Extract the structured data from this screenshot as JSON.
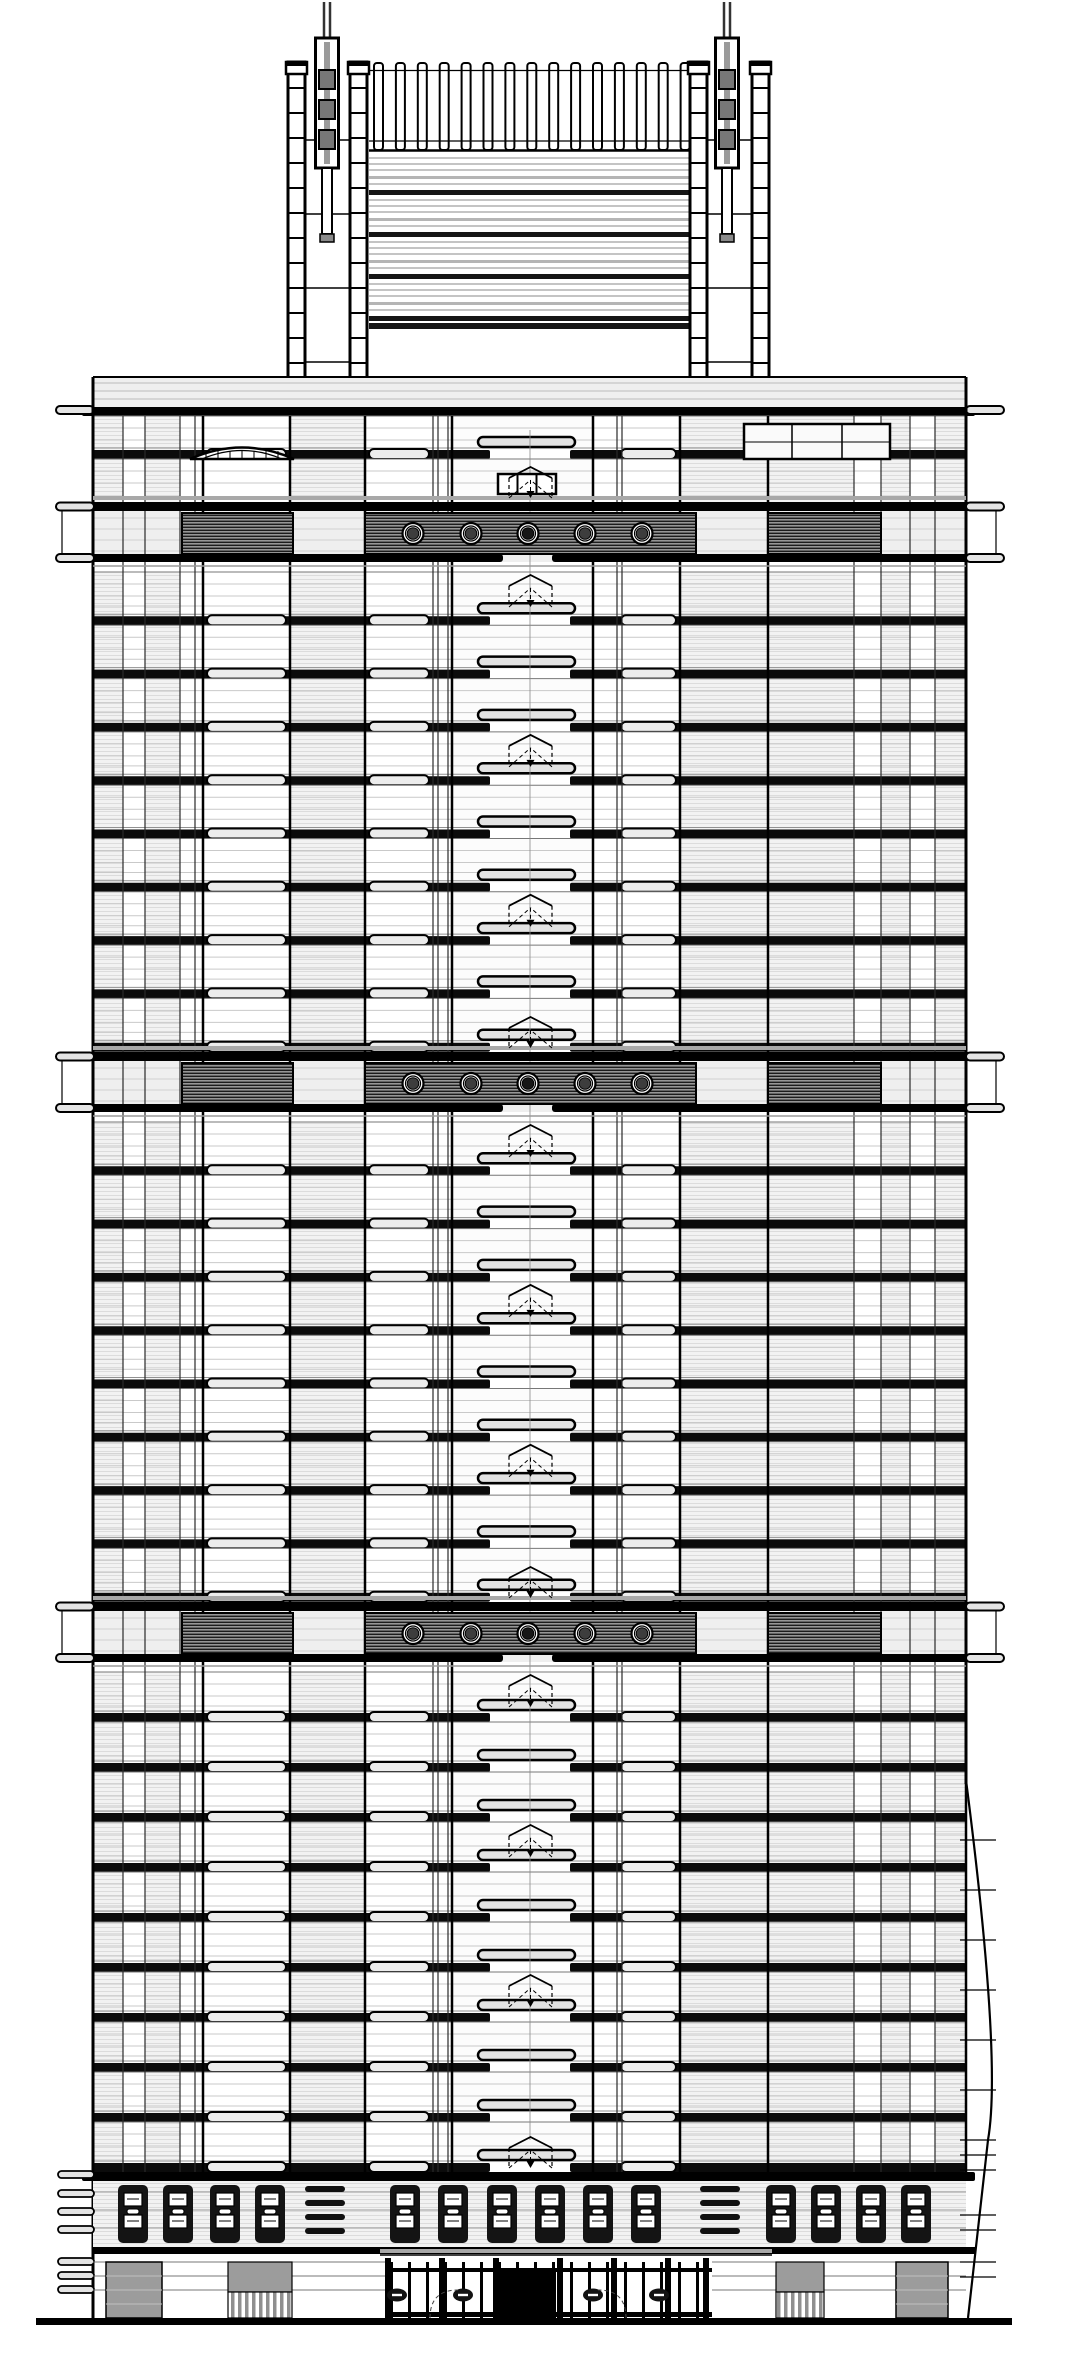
{
  "title": "High-rise office tower front elevation, black-and-white CAD architectural drawing with twin rooftop antenna masts, louvered crown, three porthole mechanical bands and street-level storefront",
  "canvas": {
    "w": 1080,
    "h": 2354,
    "bg": "#ffffff"
  },
  "colors": {
    "ink": "#000000",
    "spandrel": "#0b0b0b",
    "mid": "#777777",
    "soft": "#a8a8a8",
    "faint": "#c9c9c9",
    "panelbg": "#efefef",
    "capfill": "#e4e4e4",
    "graypanel": "#9c9c9c",
    "pillfill": "#e2e2e2",
    "widepill": "#ececec",
    "mastseg": "#777777",
    "darkpanel": "#141414"
  },
  "crown": {
    "masts": {
      "cx": [
        327,
        727
      ],
      "rod_top": 2,
      "sleeve": {
        "y": 38,
        "h": 130,
        "w": 23
      },
      "segments_y": [
        70,
        100,
        130
      ],
      "segment_h": 19,
      "lower_rod": {
        "y": 168,
        "h": 66,
        "w": 10
      },
      "foot": {
        "y": 234,
        "h": 8,
        "w": 14
      }
    },
    "towers": {
      "rail_w": 17,
      "rail_pairs": [
        [
          288,
          350
        ],
        [
          690,
          752
        ]
      ],
      "y": 62,
      "h": 318,
      "rung_pitch": 25,
      "cross_pitch": 74,
      "cap_h": 12
    },
    "fins": {
      "x0": 374,
      "count": 15,
      "w": 9,
      "pitch": 21.9,
      "y": 63,
      "h": 87,
      "tie_y": [
        70.5,
        141
      ],
      "base_y": 150.5,
      "span": [
        369,
        696
      ]
    },
    "stripes": {
      "x": 369,
      "w": 327,
      "y": 152,
      "h": 178,
      "unit": 42,
      "units": 4,
      "start": 158
    }
  },
  "shoulder": {
    "slab_y": 377,
    "slab_h": 30,
    "bar_y": 407,
    "bar_h": 9,
    "lines": [
      383,
      391,
      399
    ],
    "step": {
      "x": 180,
      "w": 190,
      "y": 416,
      "h": 5
    }
  },
  "attic": {
    "rows": [
      {
        "y": 416,
        "h": 43,
        "spandrel": true
      },
      {
        "y": 459,
        "h": 43,
        "spandrel": false
      }
    ],
    "eyebrow": {
      "x1": 190,
      "x2": 294,
      "base_y": 459,
      "rise": 23,
      "tick_step": 12
    },
    "right_box": {
      "x": 744,
      "y": 424,
      "w": 146,
      "h": 35,
      "splits": [
        792,
        842
      ],
      "mid_y": 442
    },
    "tri_box": {
      "x": 498,
      "y": 474,
      "w": 58,
      "h": 20,
      "splits": [
        517.5,
        536.5
      ]
    }
  },
  "facade": {
    "left": 93,
    "right": 966,
    "top": 416,
    "bottom": 2172,
    "center_x": 530,
    "mullions_major": [
      93,
      203,
      290,
      365,
      452,
      593,
      680,
      768,
      966
    ],
    "mullions_minor": [
      123,
      145,
      180,
      195,
      433,
      438,
      448,
      617,
      622,
      854,
      881,
      910,
      935
    ],
    "bays": [
      [
        93,
        123,
        "hatch"
      ],
      [
        123,
        145,
        "plain"
      ],
      [
        145,
        180,
        "hatch"
      ],
      [
        180,
        203,
        "plain"
      ],
      [
        203,
        290,
        "wide"
      ],
      [
        290,
        365,
        "hatch"
      ],
      [
        365,
        433,
        "wide"
      ],
      [
        433,
        452,
        "plain"
      ],
      [
        593,
        617,
        "plain"
      ],
      [
        617,
        680,
        "wide"
      ],
      [
        680,
        768,
        "hatch"
      ],
      [
        768,
        854,
        "hatch"
      ],
      [
        854,
        881,
        "plain"
      ],
      [
        881,
        910,
        "hatch"
      ],
      [
        910,
        935,
        "plain"
      ],
      [
        935,
        966,
        "hatch"
      ]
    ],
    "row_lines": [
      12,
      24,
      34
    ]
  },
  "core": {
    "x": 452,
    "w": 141,
    "pill": {
      "x": 478,
      "w": 97,
      "h": 10
    },
    "arch": {
      "x1": 509,
      "x2": 552,
      "cx": 530.5,
      "h": 36
    },
    "arch_rows": [
      0,
      3,
      6
    ],
    "spandrel_gap": [
      490,
      570
    ]
  },
  "sections": [
    {
      "y0": 572,
      "floors": 9,
      "pitch": 53.3
    },
    {
      "y0": 1122,
      "floors": 9,
      "pitch": 53.3
    },
    {
      "y0": 1672,
      "floors": 10,
      "pitch": 50
    }
  ],
  "bands": {
    "tops": [
      502,
      1052,
      1602
    ],
    "bar_h": 9,
    "hatch_top": 11,
    "hatch_h": 41,
    "left_box": [
      182,
      293
    ],
    "center_box": [
      365,
      696
    ],
    "right_box": [
      768,
      881
    ],
    "circles": {
      "cx": [
        413,
        471,
        528,
        585,
        642
      ],
      "cy_off": 31.5,
      "r_outer": 10.5,
      "r_ring": 7.5,
      "r_inner": 5.8
    },
    "bottom_gap": [
      503,
      552
    ],
    "bar_x": 82,
    "bar_w": 893
  },
  "base": {
    "bar_y": 2172,
    "bar_h": 9,
    "panel_band": {
      "y": 2181,
      "h": 66,
      "lines": [
        2192,
        2210,
        2228
      ]
    },
    "panels": {
      "y": 2185,
      "h": 58,
      "w": 30,
      "x_left": [
        118,
        163,
        210,
        255
      ],
      "x_center": [
        390,
        438,
        487,
        535,
        583,
        631
      ],
      "x_right": [
        766,
        811,
        856,
        901
      ]
    },
    "pill_stacks": {
      "x": [
        305,
        700
      ],
      "w": 40,
      "ys": [
        2186,
        2200,
        2214,
        2228
      ],
      "h": 6
    },
    "bar2_y": 2247,
    "bar2_h": 7,
    "left_cap_ys": [
      2171,
      2190,
      2208,
      2226,
      2258,
      2272,
      2286
    ]
  },
  "ground": {
    "y": 2254,
    "lines": [
      2262,
      2276,
      2290
    ],
    "gray_a": {
      "x": 106,
      "y": 2262,
      "w": 56,
      "h": 56
    },
    "gray_b": {
      "x": 228,
      "y": 2262,
      "w": 64,
      "h": 56,
      "split": 2292
    },
    "gray_c": {
      "x": 776,
      "y": 2262,
      "w": 48,
      "h": 56,
      "split": 2292
    },
    "gray_d": {
      "x": 896,
      "y": 2262,
      "w": 52,
      "h": 56
    },
    "canopy": {
      "x": 380,
      "w": 392,
      "y": 2249,
      "h": 4,
      "edge_y": 2255
    },
    "storefront": {
      "x1": 388,
      "x2": 712,
      "top": 2258,
      "bottom": 2318,
      "pier_xs": [
        388,
        442,
        496,
        560,
        614,
        668,
        706
      ],
      "mullion_step": 18,
      "mid_rail_y": 2268,
      "sill_y": 2312,
      "door": {
        "x": 500,
        "w": 56,
        "y": 2272
      },
      "ovals_cx": [
        397,
        463,
        593,
        659
      ],
      "oval_cy": 2295,
      "arcs_x": [
        430,
        626
      ]
    },
    "ground_line": {
      "x": 36,
      "w": 976,
      "y": 2318,
      "h": 7
    }
  },
  "right_edge": {
    "curve_start_y": 1780,
    "ctrl": [
      1002,
      2060
    ],
    "knee": [
      988,
      2140
    ],
    "end": [
      968,
      2318
    ],
    "tick_ys": [
      1840,
      1890,
      1940,
      1990,
      2040,
      2090,
      2140,
      2155,
      2170,
      2215,
      2230,
      2262,
      2277
    ],
    "tick_x1": 960,
    "tick_x2": 996
  },
  "caps": {
    "w": 38,
    "h": 8,
    "left_x": 56,
    "right_x": 966,
    "shoulder_y": 406
  }
}
